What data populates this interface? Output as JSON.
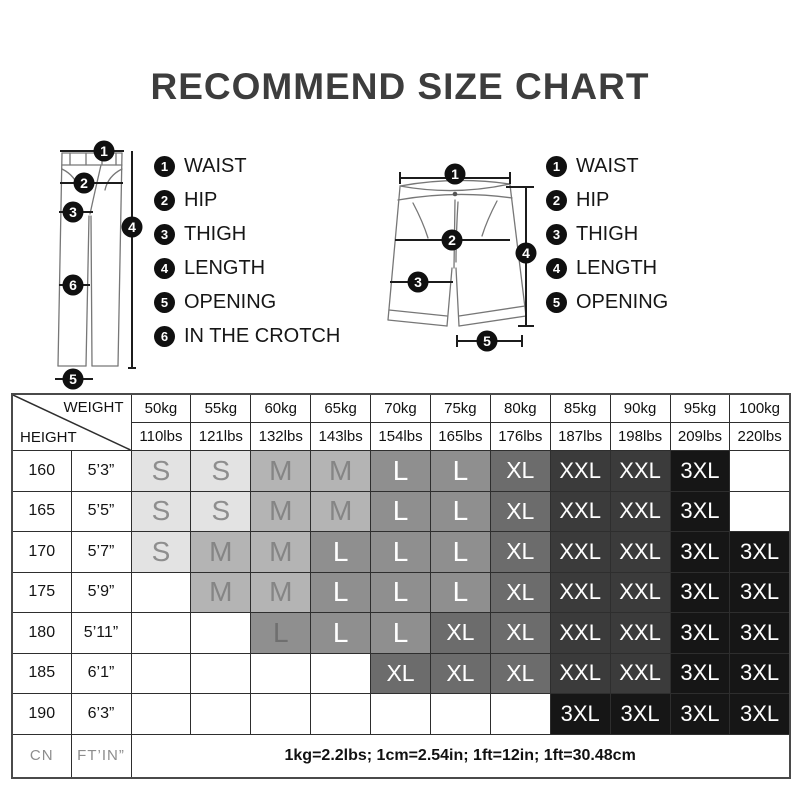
{
  "title": "RECOMMEND SIZE CHART",
  "pants_diagram": {
    "markers": {
      "waist": "1",
      "hip": "2",
      "thigh": "3",
      "length": "4",
      "crotch": "6",
      "opening": "5"
    }
  },
  "shorts_diagram": {
    "markers": {
      "waist": "1",
      "hip": "2",
      "thigh": "3",
      "length": "4",
      "opening": "5"
    }
  },
  "legend_pants": {
    "items": [
      {
        "num": "1",
        "label": "WAIST"
      },
      {
        "num": "2",
        "label": "HIP"
      },
      {
        "num": "3",
        "label": "THIGH"
      },
      {
        "num": "4",
        "label": "LENGTH"
      },
      {
        "num": "5",
        "label": "OPENING"
      },
      {
        "num": "6",
        "label": "IN THE CROTCH"
      }
    ]
  },
  "legend_shorts": {
    "items": [
      {
        "num": "1",
        "label": "WAIST"
      },
      {
        "num": "2",
        "label": "HIP"
      },
      {
        "num": "3",
        "label": "THIGH"
      },
      {
        "num": "4",
        "label": "LENGTH"
      },
      {
        "num": "5",
        "label": "OPENING"
      }
    ]
  },
  "table": {
    "corner": {
      "weight": "WEIGHT",
      "height": "HEIGHT"
    },
    "weights_kg": [
      "50kg",
      "55kg",
      "60kg",
      "65kg",
      "70kg",
      "75kg",
      "80kg",
      "85kg",
      "90kg",
      "95kg",
      "100kg"
    ],
    "weights_lbs": [
      "110lbs",
      "121lbs",
      "132lbs",
      "143lbs",
      "154lbs",
      "165lbs",
      "176lbs",
      "187lbs",
      "198lbs",
      "209lbs",
      "220lbs"
    ],
    "rows": [
      {
        "height_cm": "160",
        "height_ftin": "5’3”",
        "sizes": [
          "S",
          "S",
          "M",
          "M",
          "L",
          "L",
          "XL",
          "XXL",
          "XXL",
          "3XL",
          ""
        ],
        "muted": []
      },
      {
        "height_cm": "165",
        "height_ftin": "5’5”",
        "sizes": [
          "S",
          "S",
          "M",
          "M",
          "L",
          "L",
          "XL",
          "XXL",
          "XXL",
          "3XL",
          ""
        ],
        "muted": []
      },
      {
        "height_cm": "170",
        "height_ftin": "5’7”",
        "sizes": [
          "S",
          "M",
          "M",
          "L",
          "L",
          "L",
          "XL",
          "XXL",
          "XXL",
          "3XL",
          "3XL"
        ],
        "muted": []
      },
      {
        "height_cm": "175",
        "height_ftin": "5’9”",
        "sizes": [
          "",
          "M",
          "M",
          "L",
          "L",
          "L",
          "XL",
          "XXL",
          "XXL",
          "3XL",
          "3XL"
        ],
        "muted": []
      },
      {
        "height_cm": "180",
        "height_ftin": "5’11”",
        "sizes": [
          "",
          "",
          "L",
          "L",
          "L",
          "XL",
          "XL",
          "XXL",
          "XXL",
          "3XL",
          "3XL"
        ],
        "muted": [
          2
        ]
      },
      {
        "height_cm": "185",
        "height_ftin": "6’1”",
        "sizes": [
          "",
          "",
          "",
          "",
          "XL",
          "XL",
          "XL",
          "XXL",
          "XXL",
          "3XL",
          "3XL"
        ],
        "muted": []
      },
      {
        "height_cm": "190",
        "height_ftin": "6’3”",
        "sizes": [
          "",
          "",
          "",
          "",
          "",
          "",
          "",
          "3XL",
          "3XL",
          "3XL",
          "3XL"
        ],
        "muted": []
      }
    ],
    "footer": {
      "height_unit": "CN",
      "ftin_unit": "FT’IN”",
      "note": "1kg=2.2lbs; 1cm=2.54in; 1ft=12in; 1ft=30.48cm"
    }
  },
  "colors": {
    "sizes": {
      "S": {
        "bg": "#e3e3e3",
        "fg": "#8e8e8e"
      },
      "M": {
        "bg": "#b4b4b4",
        "fg": "#858585"
      },
      "L": {
        "bg": "#8f8f8f",
        "fg": "#ffffff"
      },
      "XL": {
        "bg": "#6c6c6c",
        "fg": "#ffffff"
      },
      "XXL": {
        "bg": "#3b3b3b",
        "fg": "#ffffff"
      },
      "3XL": {
        "bg": "#161616",
        "fg": "#ffffff"
      }
    },
    "muted_text": "#6f6f6f",
    "empty_bg": "#ffffff"
  }
}
